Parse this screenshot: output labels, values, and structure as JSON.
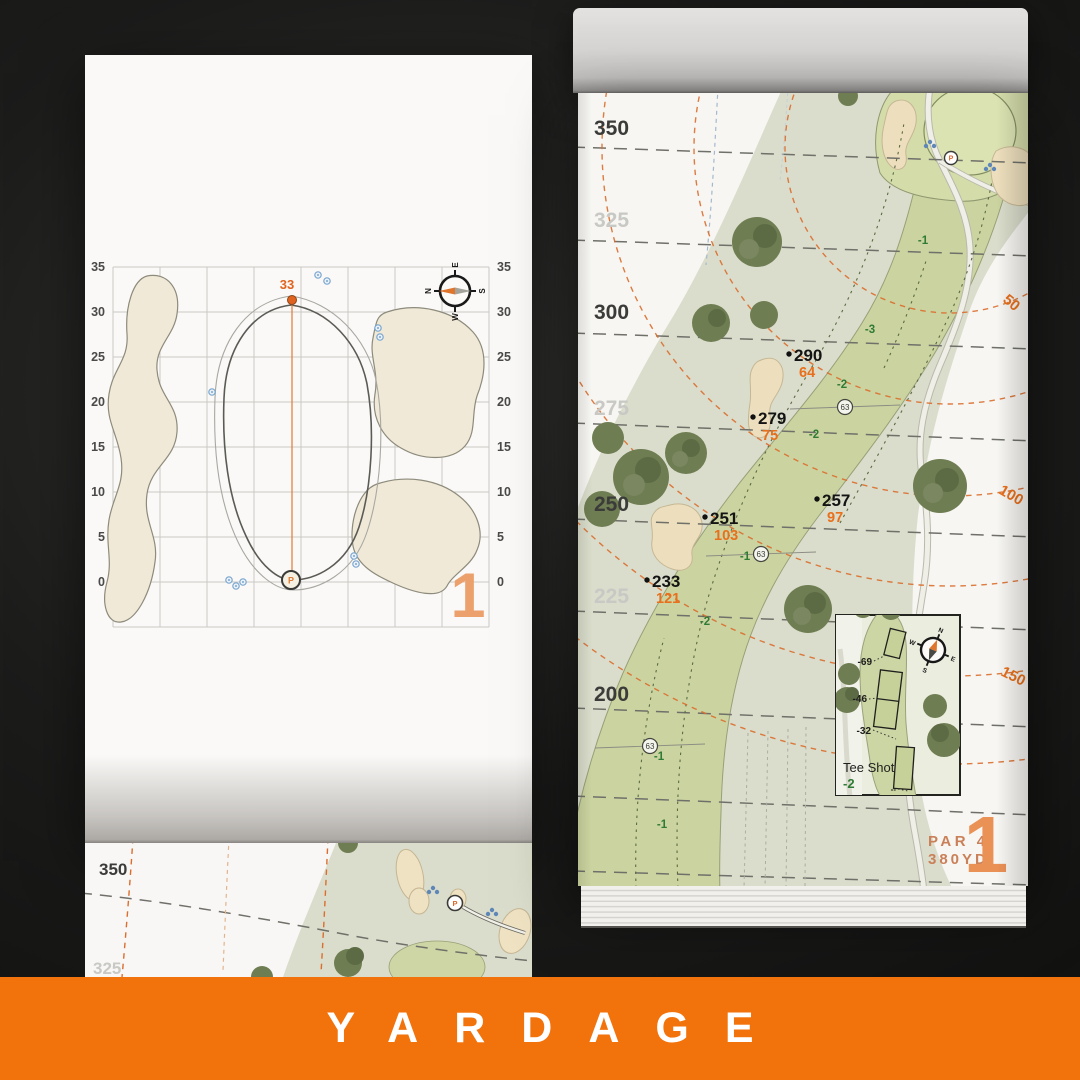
{
  "banner": {
    "title": "YARDAGE"
  },
  "colors": {
    "accent_orange": "#F2720B",
    "label_orange": "#E8701C",
    "fairway_green": "#CBD4A0",
    "tree_green": "#6F7D53",
    "slope_green": "#2F7A35",
    "bunker_sand": "#EDDFBD"
  },
  "left_page": {
    "hole_number": "1",
    "pin_distance": "33",
    "pin_marker": "P",
    "axis_labels": [
      "35",
      "30",
      "25",
      "20",
      "15",
      "10",
      "5",
      "0"
    ],
    "compass": {
      "n": "N",
      "e": "E",
      "s": "S",
      "w": "W"
    }
  },
  "right_page": {
    "hole_number": "1",
    "par": "PAR 4",
    "total_yardage": "380YD",
    "tee_distance_labels": [
      "350",
      "325",
      "300",
      "275",
      "250",
      "225",
      "200"
    ],
    "green_distance_labels": [
      "50",
      "100",
      "150"
    ],
    "carry_points": [
      {
        "from_tee": "290",
        "to_green": "64"
      },
      {
        "from_tee": "279",
        "to_green": "75"
      },
      {
        "from_tee": "257",
        "to_green": "97"
      },
      {
        "from_tee": "251",
        "to_green": "103"
      },
      {
        "from_tee": "233",
        "to_green": "121"
      }
    ],
    "fairway_width_markers": [
      "63",
      "63",
      "63"
    ],
    "slope_values": [
      "-1",
      "-3",
      "-2",
      "-2",
      "-1",
      "-2",
      "-1",
      "-1"
    ],
    "pin_marker": "P",
    "compass": {
      "n": "N",
      "e": "E",
      "s": "S",
      "w": "W"
    },
    "tee_inset": {
      "title": "Tee Shot",
      "slope": "-2",
      "markers": [
        "-69",
        "-46",
        "-32",
        "--"
      ]
    }
  },
  "under_page": {
    "tee_distance_labels": [
      "350",
      "325"
    ]
  }
}
